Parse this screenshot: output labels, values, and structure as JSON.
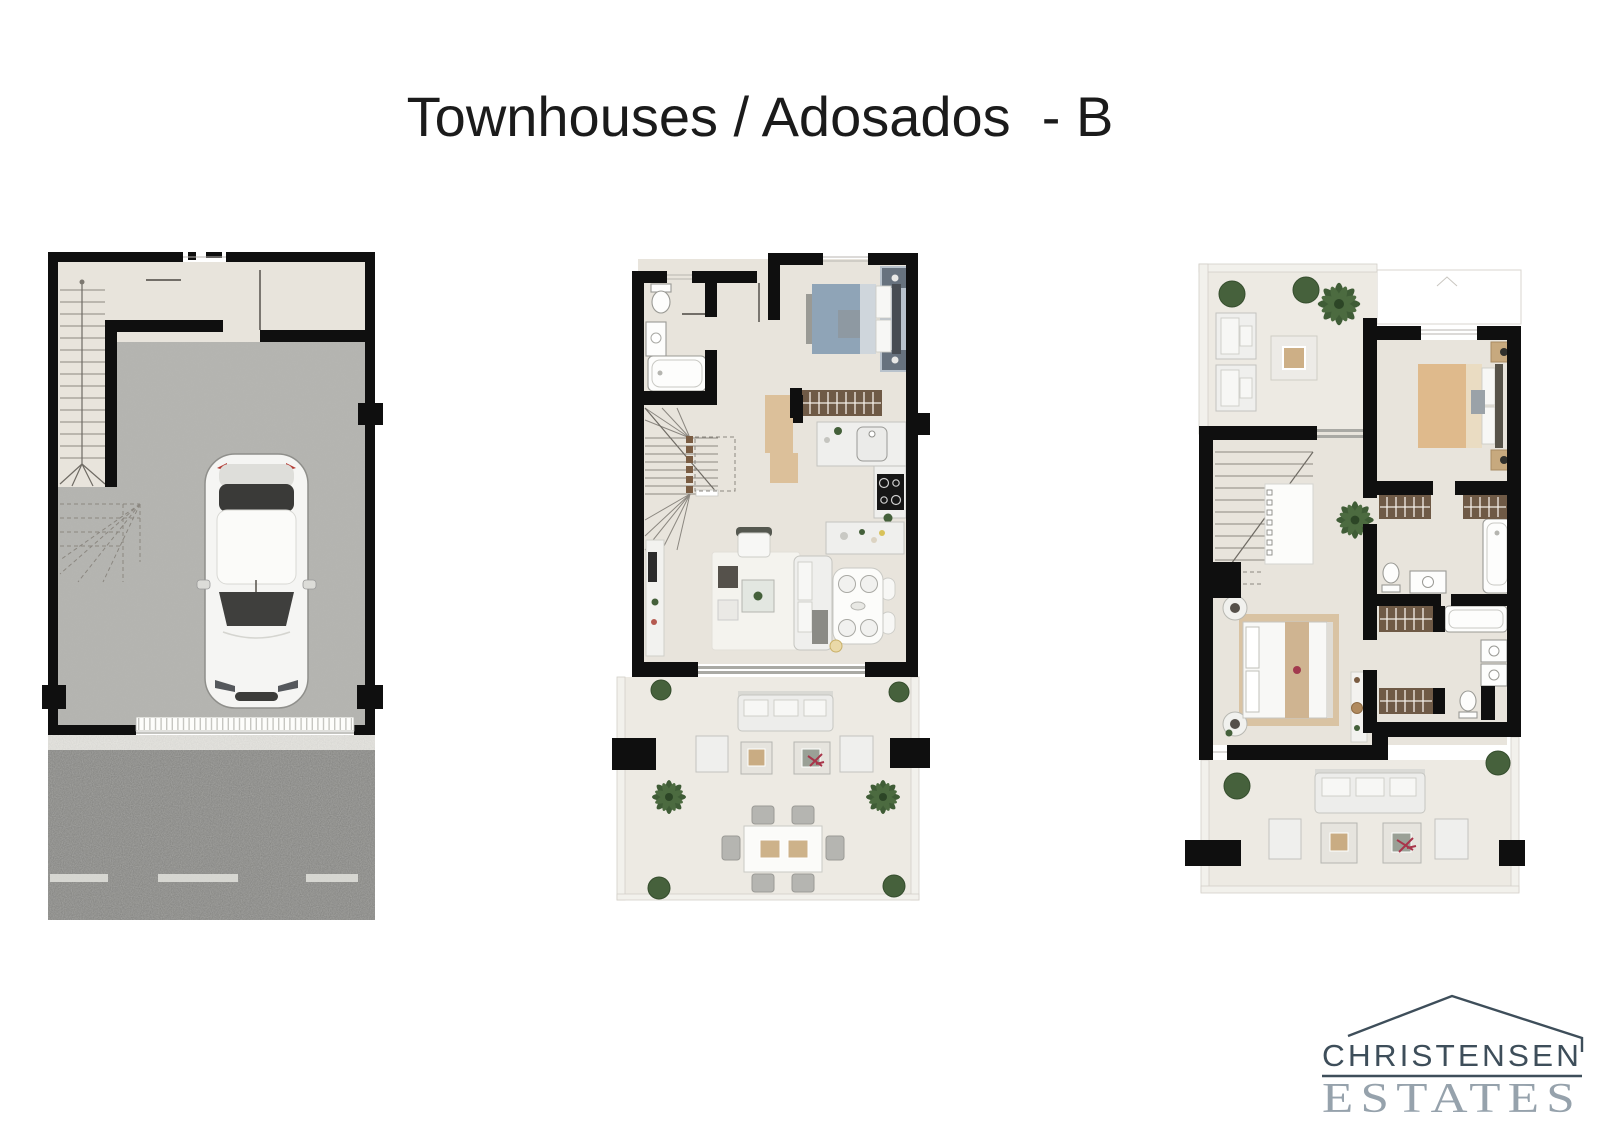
{
  "title": "Townhouses / Adosados  - B",
  "logo": {
    "name": "CHRISTENSEN",
    "tagline": "ESTATES"
  },
  "figures": [
    "basement-garage-floor-plan",
    "main-living-floor-plan",
    "upper-bedrooms-floor-plan"
  ],
  "colors": {
    "background": "#ffffff",
    "title_text": "#1b1b1b",
    "wall": "#0f0f0f",
    "tile_floor": "#e8e4dc",
    "tile_floor_light": "#edeae3",
    "concrete": "#b5b5b1",
    "asphalt": "#7c7c79",
    "wood": "#dcc09a",
    "wardrobe": "#6f5a46",
    "bed_blue": "#8fa4b7",
    "bed_tan": "#dfba8c",
    "plant": "#44603a",
    "furniture_white": "#efefed",
    "furniture_gray": "#b5b5b1",
    "logo_dark": "#3e4e5a",
    "logo_light": "#96a2ac"
  }
}
